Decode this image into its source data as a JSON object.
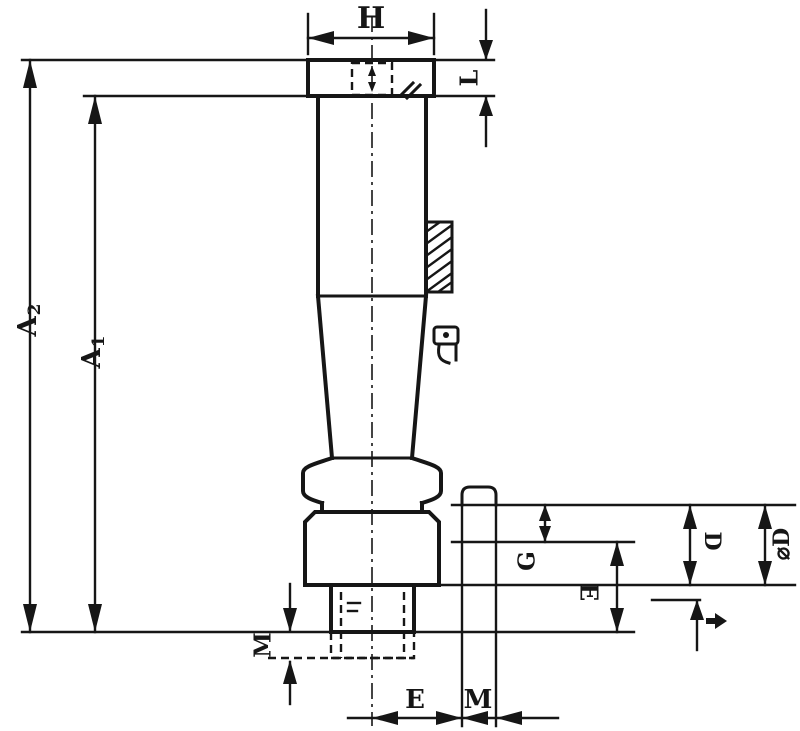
{
  "colors": {
    "ink": "#161616",
    "background": "#ffffff"
  },
  "dimensions": {
    "top_width": "H",
    "top_right_height": "L",
    "length_outer": {
      "base": "A",
      "sub": "2"
    },
    "length_inner": {
      "base": "A",
      "sub": "1"
    },
    "side_g": "G",
    "side_e": "E",
    "side_d": "D",
    "side_diameter": "⌀D",
    "bottom_side_m": "M",
    "bottom_e": "E",
    "bottom_m": "M"
  },
  "markers": {
    "gap_marker": "small-right-arrow",
    "center_line": "dash-dot-centerline",
    "hidden_edges": "dashed-lines"
  }
}
